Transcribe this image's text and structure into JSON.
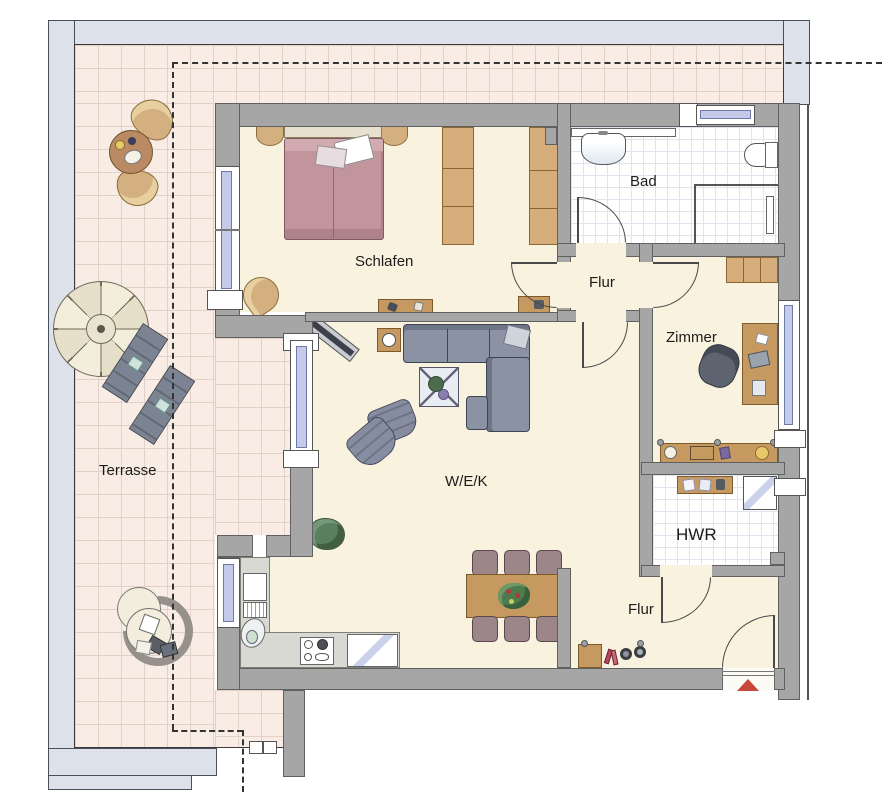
{
  "floorplan": {
    "type": "apartment-floor-plan",
    "rooms": [
      {
        "id": "terrasse",
        "label": "Terrasse"
      },
      {
        "id": "schlafen",
        "label": "Schlafen"
      },
      {
        "id": "bad",
        "label": "Bad"
      },
      {
        "id": "flur-mitte",
        "label": "Flur"
      },
      {
        "id": "zimmer",
        "label": "Zimmer"
      },
      {
        "id": "wek",
        "label": "W/E/K"
      },
      {
        "id": "hwr",
        "label": "HWR"
      },
      {
        "id": "flur-sued",
        "label": "Flur"
      }
    ],
    "colors": {
      "wall": "#a6a6a6",
      "outer_band": "#dce1ea",
      "terrace_tile": "#f9ece4",
      "interior_floor": "#f8f2de",
      "wet_room_floor": "#ffffff",
      "window_glass": "#c3cbe9",
      "wood": "#c5995f",
      "sofa": "#8b92a3",
      "bed": "#c2949b",
      "entrance_arrow": "#c7473b"
    },
    "markers": {
      "entrance_arrow": "entrance-direction-triangle"
    }
  }
}
